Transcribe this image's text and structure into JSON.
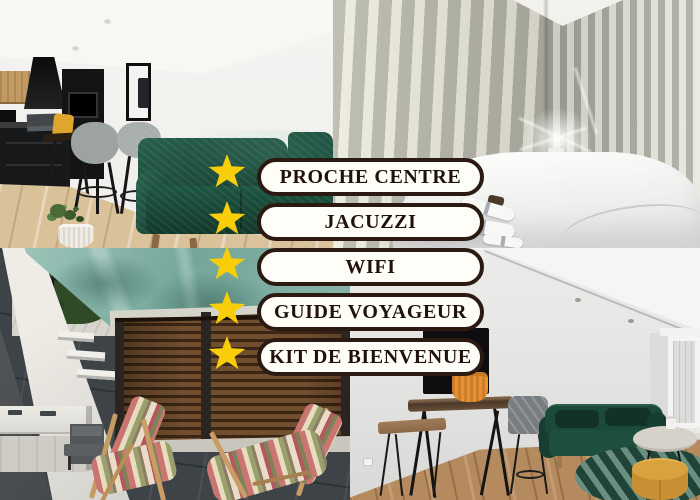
{
  "badges": {
    "items": [
      {
        "label": "PROCHE CENTRE"
      },
      {
        "label": "JACUZZI"
      },
      {
        "label": "WIFI"
      },
      {
        "label": "GUIDE VOYAGEUR"
      },
      {
        "label": "KIT DE BIENVENUE"
      }
    ]
  },
  "colors": {
    "star_color": "#f8ce0a",
    "pill_bg": "#fffdf8",
    "pill_border": "#2b1a12",
    "pill_text": "#20120a",
    "sofa_green": "#1d4f3e",
    "tarp_teal": "#74a699",
    "fence_brown": "#714e2e",
    "planter_orange": "#e89130",
    "pouf_yellow": "#d9a23f",
    "stripe_sage": "#aeafa1",
    "stripe_cream": "#e8e7df"
  },
  "photos": {
    "top_left": "living room with kitchen",
    "top_right": "bedroom",
    "bottom_left": "terrace with deck chairs",
    "bottom_right": "lounge with bar table"
  }
}
